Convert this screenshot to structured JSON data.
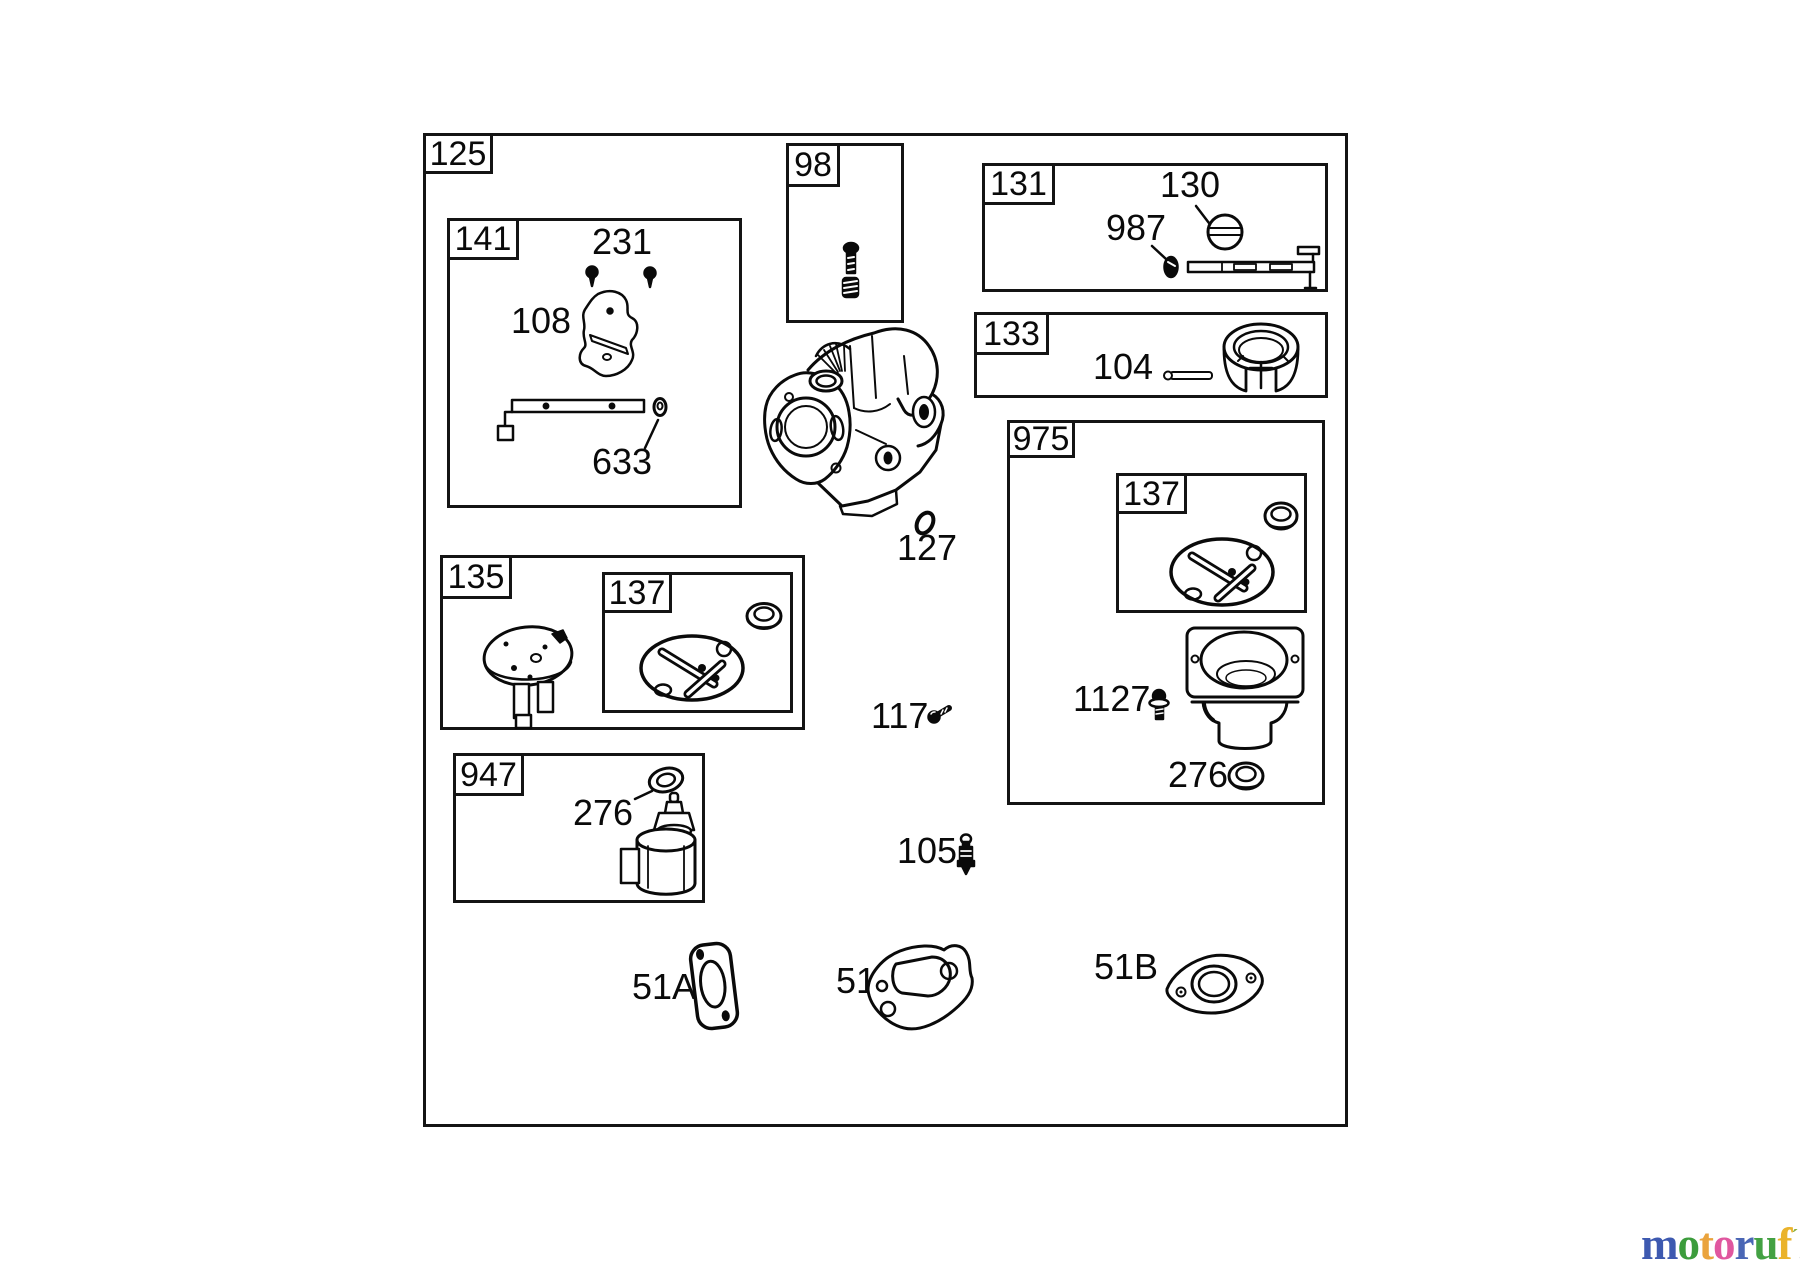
{
  "page": {
    "background": "#ffffff",
    "line_color": "#0a0a0a"
  },
  "diagram": {
    "outer_box_label": "125",
    "section_boxes": [
      {
        "id": "141",
        "label": "141"
      },
      {
        "id": "98",
        "label": "98"
      },
      {
        "id": "131",
        "label": "131"
      },
      {
        "id": "133",
        "label": "133"
      },
      {
        "id": "975",
        "label": "975"
      },
      {
        "id": "137-upper",
        "label": "137"
      },
      {
        "id": "135",
        "label": "135"
      },
      {
        "id": "137-lower",
        "label": "137"
      },
      {
        "id": "947",
        "label": "947"
      }
    ],
    "part_labels": [
      {
        "id": "231",
        "text": "231"
      },
      {
        "id": "108",
        "text": "108"
      },
      {
        "id": "633",
        "text": "633"
      },
      {
        "id": "130",
        "text": "130"
      },
      {
        "id": "987",
        "text": "987"
      },
      {
        "id": "104",
        "text": "104"
      },
      {
        "id": "127",
        "text": "127"
      },
      {
        "id": "117",
        "text": "117"
      },
      {
        "id": "1127",
        "text": "1127"
      },
      {
        "id": "276-bowl",
        "text": "276"
      },
      {
        "id": "276-solenoid",
        "text": "276"
      },
      {
        "id": "105",
        "text": "105"
      },
      {
        "id": "51A",
        "text": "51A"
      },
      {
        "id": "51",
        "text": "51"
      },
      {
        "id": "51B",
        "text": "51B"
      }
    ],
    "drawings": [
      "carburetor-body",
      "mounting-screws-231",
      "governor-plate-108",
      "link-rod-633",
      "idle-screw-spring-98",
      "throttle-plate-130",
      "screw-987",
      "throttle-shaft-131",
      "pin-104",
      "intake-collar-133",
      "seal-ring-137",
      "diaphragm-gasket-137",
      "pump-cover-135",
      "float-bowl-975",
      "bowl-screw-1127",
      "seal-276",
      "o-ring-127",
      "screw-117",
      "needle-valve-105",
      "gasket-51A",
      "gasket-51",
      "gasket-51B"
    ]
  },
  "footer": {
    "logo": {
      "letters": [
        {
          "ch": "m",
          "color": "#3d59b0"
        },
        {
          "ch": "o",
          "color": "#3c9c3c"
        },
        {
          "ch": "t",
          "color": "#eaa33d"
        },
        {
          "ch": "o",
          "color": "#e0579f"
        },
        {
          "ch": "r",
          "color": "#4a66b5"
        },
        {
          "ch": "u",
          "color": "#43a143"
        },
        {
          "ch": "f",
          "color": "#eab32c"
        }
      ],
      "mark": "ˊ",
      "mark_color": "#8aae3a",
      "suffix": ".de",
      "suffix_color": "#4a4a42"
    }
  }
}
